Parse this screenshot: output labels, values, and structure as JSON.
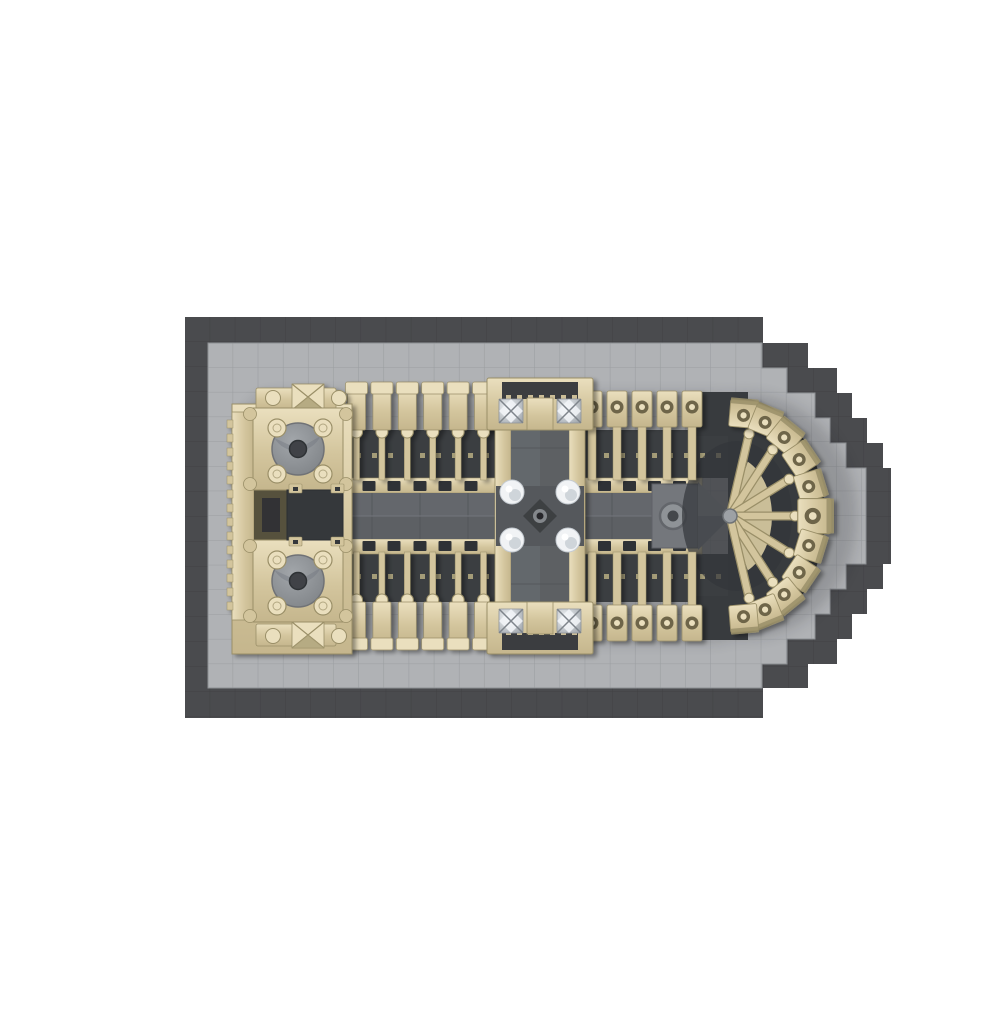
{
  "image": {
    "type": "product-render",
    "subject": "Aerial top view of a brick-built Notre-Dame cathedral model on a pixelated cathedral-plan baseplate",
    "background": "#ffffff"
  },
  "palette": {
    "plate_dark": "#4a4b4e",
    "plate_dark_seam": "#3e3f41",
    "plate_light": "#b0b2b5",
    "plate_grid": "#9b9ea1",
    "tan": "#d3c59d",
    "tan_light": "#eadfbe",
    "tan_mid": "#c5b68d",
    "tan_dark": "#9a8f68",
    "tan_deep": "#6e6549",
    "roof_gray": "#5d6064",
    "roof_gray_top": "#64676c",
    "roof_gray_light": "#85888d",
    "choir_block_gray": "#74777c",
    "aisle_dark": "#3b3e41",
    "apse_dark": "#383b3e",
    "window_dark": "#2f3236",
    "disc_gray_hi": "#a2a6aa",
    "disc_gray_lo": "#7e8286",
    "disc_hole": "#3f4246",
    "chrome_hi": "#f2f5f8",
    "chrome_lo": "#9aa0a6",
    "pinnacle_white": "#f1f3f5",
    "pinnacle_shade": "#c9cfd5",
    "ground_shadow": "#17191b"
  },
  "model": {
    "towers": 2,
    "tower_discs": 2,
    "west_buttresses_per_side": 6,
    "east_buttresses_per_side": 5,
    "apse_chapels": 11,
    "apse_flying_buttress_rods": 7,
    "crossing_pinnacles": 4,
    "transept_chrome_finials": 4,
    "facade_pyramids": 2,
    "choir_ring_ornaments": 1
  },
  "baseplate": {
    "shape": "rectangle with stepped semicircular apse end",
    "border_color_name": "dark gray",
    "field_color_name": "light gray",
    "tile_size_px": 25
  }
}
